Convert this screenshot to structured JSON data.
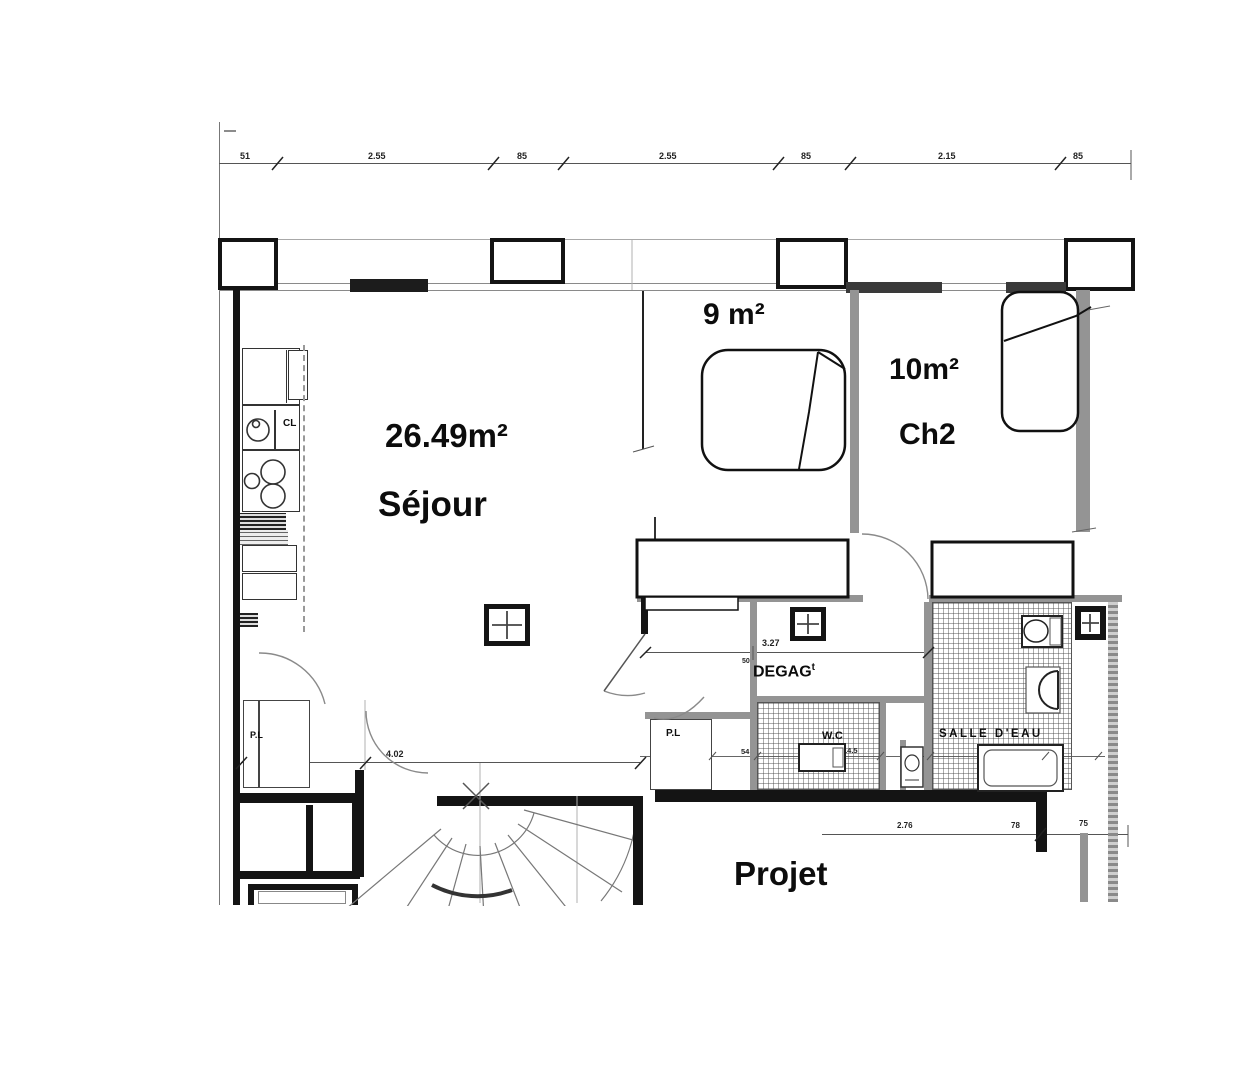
{
  "title": {
    "project_label": "Projet"
  },
  "rooms": {
    "sejour": {
      "area": "26.49m²",
      "name": "Séjour"
    },
    "ch1": {
      "area": "9 m²",
      "name": "ch1"
    },
    "ch2": {
      "area": "10m²",
      "name": "Ch2"
    },
    "degag": {
      "label": "DEGAG",
      "sup": "t"
    },
    "wc": {
      "label": "W.C"
    },
    "salle_eau": {
      "label": "SALLE D'EAU"
    },
    "pl_hall": {
      "label": "P.L"
    },
    "pl_sejour": {
      "label": "P.L"
    },
    "kitchen": {
      "closet_label": "CL"
    }
  },
  "dimensions": {
    "top": [
      "51",
      "2.55",
      "85",
      "2.55",
      "85",
      "2.15",
      "85"
    ],
    "sejour_width": "4.02",
    "degag_width": "3.27",
    "degag_depth": "50",
    "hall_segments": [
      "92",
      "54",
      "14.5",
      "40",
      "1.73"
    ],
    "bottom_right": [
      "2.76",
      "78",
      "75"
    ]
  }
}
